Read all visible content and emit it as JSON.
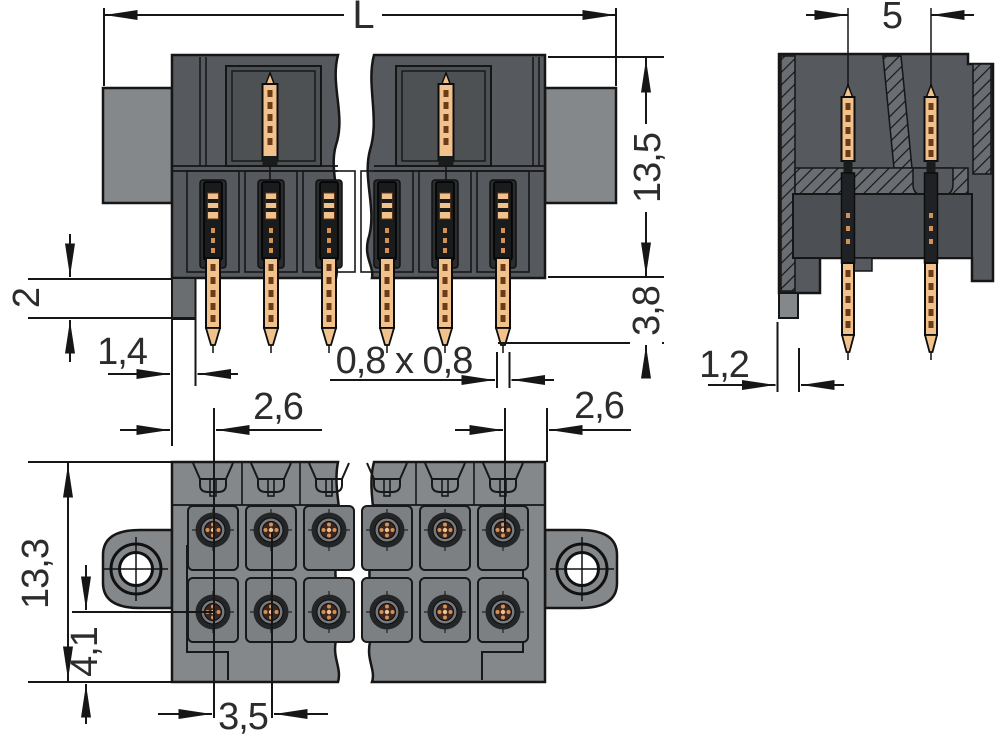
{
  "dimensions": {
    "overall_length": "L",
    "row_spacing": "5",
    "height_above_board": "13,5",
    "pin_protrusion": "3,8",
    "board_thickness": "2",
    "foot_width_front": "1,4",
    "pin_cross_section": "0,8 x 0,8",
    "edge_to_first_pin": "2,6",
    "last_pin_to_edge": "2,6",
    "foot_width_side": "1,2",
    "total_depth": "13,3",
    "pin_row_to_edge": "4,1",
    "pin_pitch": "3,5"
  },
  "colors": {
    "housing_dark": "#56595d",
    "housing_mid": "#4c4f53",
    "housing_light": "#85888b",
    "pin_copper": "#f2c28c",
    "pin_dash": "#6b3c19",
    "outline": "#161617",
    "dimension_text": "#2c2c2c",
    "background": "#ffffff"
  }
}
